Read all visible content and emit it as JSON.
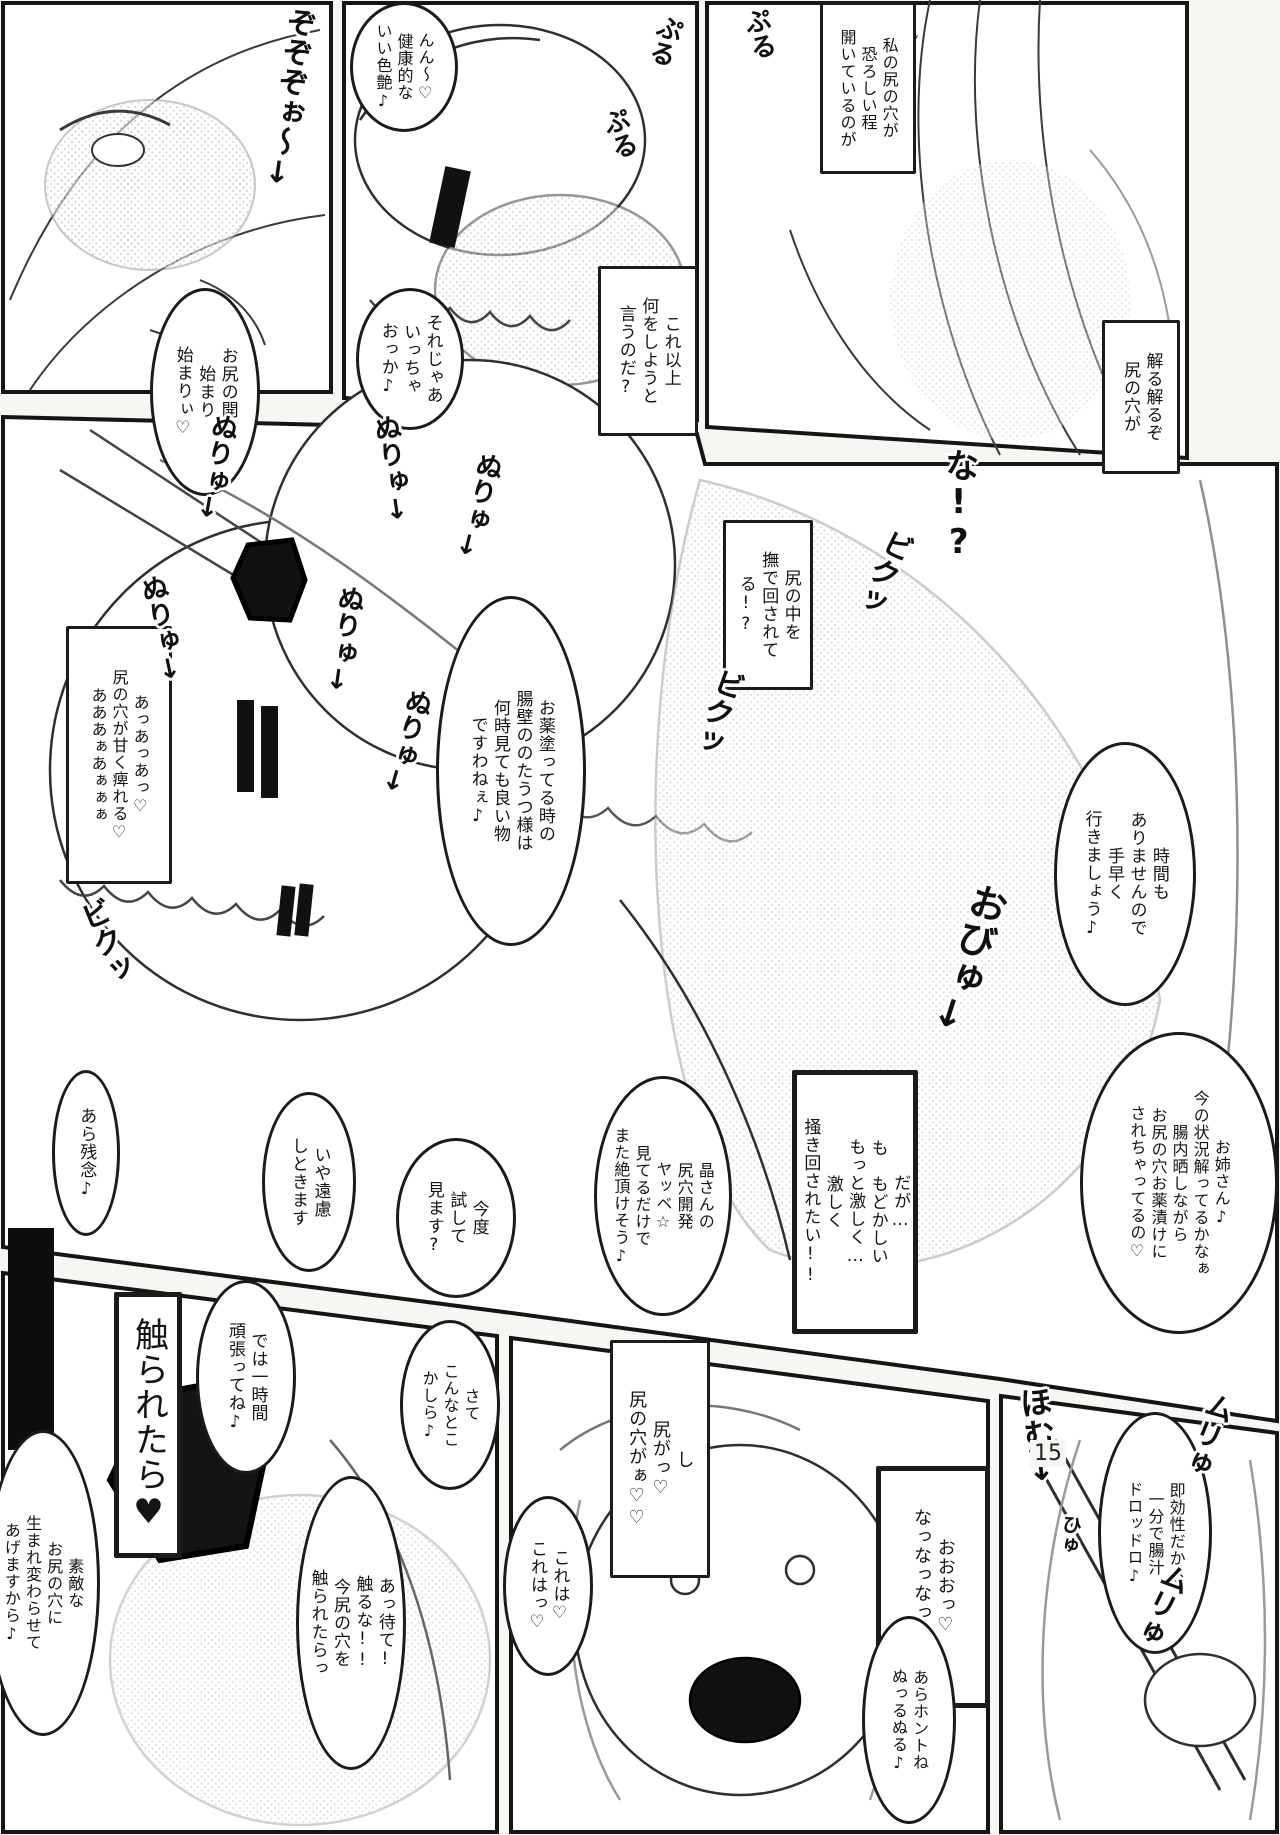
{
  "page_number": "15",
  "colors": {
    "ink": "#1b1b1b",
    "paper": "#ffffff",
    "tone": "#c9c9c9"
  },
  "bubbles": [
    {
      "name": "narration-box-my-hole",
      "kind": "box",
      "text": "私の尻の穴が\n恐ろしい程\n開いているのが",
      "x": 820,
      "y": 2,
      "w": 96,
      "h": 172,
      "fs": 16
    },
    {
      "name": "speech-bubble-healthy-luster",
      "kind": "ellipse",
      "text": "んん〜♡\n健康的な\nいい色艶♪",
      "x": 350,
      "y": 2,
      "w": 108,
      "h": 130,
      "fs": 16
    },
    {
      "name": "narration-box-what-more",
      "kind": "box",
      "text": "これ以上\n何をしようと\n言うのだ?",
      "x": 598,
      "y": 266,
      "w": 100,
      "h": 170,
      "fs": 17
    },
    {
      "name": "speech-bubble-lets-go",
      "kind": "ellipse",
      "text": "それじゃあ\nいっちゃ\nおっか♪",
      "x": 356,
      "y": 288,
      "w": 108,
      "h": 142,
      "fs": 17
    },
    {
      "name": "speech-bubble-development-begins",
      "kind": "ellipse",
      "text": "お尻の開発\n始まり\n始まりぃ♡",
      "x": 150,
      "y": 288,
      "w": 110,
      "h": 208,
      "fs": 17
    },
    {
      "name": "narration-box-i-understand",
      "kind": "box",
      "text": "解る解るぞ\n尻の穴が",
      "x": 1102,
      "y": 320,
      "w": 78,
      "h": 154,
      "fs": 17
    },
    {
      "name": "narration-box-being-rubbed",
      "kind": "box",
      "text": "尻の中を\n撫で回されてる!?",
      "x": 723,
      "y": 520,
      "w": 90,
      "h": 170,
      "fs": 17
    },
    {
      "name": "narration-box-numb-moan",
      "kind": "box",
      "text": "あっあっあっ♡\n尻の穴が甘く痺れる♡\nあああぁあぁぁぁ",
      "x": 66,
      "y": 626,
      "w": 106,
      "h": 258,
      "fs": 16
    },
    {
      "name": "speech-bubble-medicine-view",
      "kind": "ellipse",
      "text": "お薬塗ってる時の\n腸壁ののたうつ様は\n何時見ても良い物\nですわねぇ♪",
      "x": 436,
      "y": 596,
      "w": 150,
      "h": 350,
      "fs": 17
    },
    {
      "name": "speech-bubble-no-time",
      "kind": "ellipse",
      "text": "時間も\nありませんので\n手早く\n行きましょう♪",
      "x": 1054,
      "y": 742,
      "w": 142,
      "h": 264,
      "fs": 17
    },
    {
      "name": "speech-bubble-onee-san",
      "kind": "ellipse",
      "text": "お姉さん♪\n今の状況解ってるかなぁ\n腸内晒しながら\nお尻の穴お薬漬けに\nされちゃってるの♡",
      "x": 1080,
      "y": 1032,
      "w": 198,
      "h": 302,
      "fs": 16
    },
    {
      "name": "narration-box-stir-harder",
      "kind": "boxbold",
      "text": "だが…\nも　もどかしい\nもっと激しく…\n激しく\n掻き回されたい!!",
      "x": 792,
      "y": 1070,
      "w": 126,
      "h": 264,
      "fs": 17
    },
    {
      "name": "speech-bubble-akira-development",
      "kind": "ellipse",
      "text": "晶さんの\n尻穴開発\nヤッベ☆\n見てるだけで\nまた絶頂けそう♪",
      "x": 594,
      "y": 1076,
      "w": 138,
      "h": 240,
      "fs": 16
    },
    {
      "name": "speech-bubble-too-bad",
      "kind": "ellipse",
      "text": "あら残念♪",
      "x": 52,
      "y": 1070,
      "w": 68,
      "h": 166,
      "fs": 17
    },
    {
      "name": "speech-bubble-no-thanks",
      "kind": "ellipse",
      "text": "いや遠慮\nしときます",
      "x": 262,
      "y": 1092,
      "w": 94,
      "h": 180,
      "fs": 17
    },
    {
      "name": "speech-bubble-try-next-time",
      "kind": "ellipse",
      "text": "今度\n試して\n見ます?",
      "x": 396,
      "y": 1138,
      "w": 120,
      "h": 160,
      "fs": 17
    },
    {
      "name": "narration-box-if-touched",
      "kind": "boxbold",
      "text": "触られたら♥",
      "x": 114,
      "y": 1292,
      "w": 68,
      "h": 266,
      "fs": 34
    },
    {
      "name": "speech-bubble-one-hour",
      "kind": "ellipse",
      "text": "では一時間\n頑張ってね♪",
      "x": 196,
      "y": 1280,
      "w": 100,
      "h": 194,
      "fs": 17
    },
    {
      "name": "speech-bubble-about-here",
      "kind": "ellipse",
      "text": "さて\nこんなとこ\nかしら♪",
      "x": 400,
      "y": 1320,
      "w": 100,
      "h": 170,
      "fs": 16
    },
    {
      "name": "speech-bubble-wonderful-hole",
      "kind": "ellipse",
      "text": "素敵な\nお尻の穴に\n生まれ変わらせて\nあげますから♪",
      "x": -14,
      "y": 1430,
      "w": 114,
      "h": 306,
      "fs": 16
    },
    {
      "name": "narration-box-my-butt",
      "kind": "box",
      "text": "し\n尻がっ♡\n尻の穴がぁ♡♡",
      "x": 610,
      "y": 1340,
      "w": 100,
      "h": 238,
      "fs": 18
    },
    {
      "name": "speech-bubble-wait-dont-touch",
      "kind": "ellipse",
      "text": "あっ待て!\n触るな!!\n今尻の穴を\n触られたらっ",
      "x": 296,
      "y": 1476,
      "w": 110,
      "h": 294,
      "fs": 17
    },
    {
      "name": "speech-bubble-this-is",
      "kind": "ellipse",
      "text": "これは♡\nこれはっ♡",
      "x": 503,
      "y": 1496,
      "w": 90,
      "h": 180,
      "fs": 17
    },
    {
      "name": "narration-box-ooo",
      "kind": "boxbold",
      "text": "おおおっ♡\nなっなっなっ!?",
      "x": 876,
      "y": 1466,
      "w": 114,
      "h": 242,
      "fs": 18
    },
    {
      "name": "speech-bubble-fast-acting",
      "kind": "ellipse",
      "text": "即効性だから\n一分で腸汁\nドロッドロ♪",
      "x": 1098,
      "y": 1412,
      "w": 114,
      "h": 242,
      "fs": 16
    },
    {
      "name": "speech-bubble-really-slippery",
      "kind": "ellipse",
      "text": "あらホントね\nぬっるぬる♪",
      "x": 862,
      "y": 1616,
      "w": 94,
      "h": 208,
      "fs": 16
    }
  ],
  "sfx": [
    {
      "name": "sfx-zozozo",
      "text": "ぞぞぞぉ〜↓",
      "x": 272,
      "y": 6,
      "fs": 30,
      "rot": 8
    },
    {
      "name": "sfx-puru-1",
      "text": "ぷる",
      "x": 744,
      "y": 8,
      "fs": 26,
      "rot": -12
    },
    {
      "name": "sfx-puru-2",
      "text": "ぷる",
      "x": 650,
      "y": 14,
      "fs": 26,
      "rot": 16
    },
    {
      "name": "sfx-puru-3",
      "text": "ぷる",
      "x": 604,
      "y": 108,
      "fs": 26,
      "rot": -18
    },
    {
      "name": "sfx-na",
      "text": "な!?",
      "x": 940,
      "y": 448,
      "fs": 34,
      "rot": 0
    },
    {
      "name": "sfx-biku-1",
      "text": "ビクッ",
      "x": 866,
      "y": 526,
      "fs": 30,
      "rot": 26
    },
    {
      "name": "sfx-biku-2",
      "text": "ビクッ",
      "x": 700,
      "y": 666,
      "fs": 30,
      "rot": 20
    },
    {
      "name": "sfx-biku-3",
      "text": "ビクッ",
      "x": 88,
      "y": 898,
      "fs": 30,
      "rot": -22
    },
    {
      "name": "sfx-nuryu-1",
      "text": "ぬりゅ↓",
      "x": 200,
      "y": 412,
      "fs": 27,
      "rot": 10
    },
    {
      "name": "sfx-nuryu-2",
      "text": "ぬりゅ↓",
      "x": 376,
      "y": 414,
      "fs": 27,
      "rot": -8
    },
    {
      "name": "sfx-nuryu-3",
      "text": "ぬりゅ↓",
      "x": 462,
      "y": 450,
      "fs": 27,
      "rot": 14
    },
    {
      "name": "sfx-nuryu-4",
      "text": "ぬりゅ↓",
      "x": 146,
      "y": 574,
      "fs": 27,
      "rot": -12
    },
    {
      "name": "sfx-nuryu-5",
      "text": "ぬりゅ↓",
      "x": 328,
      "y": 584,
      "fs": 27,
      "rot": 8
    },
    {
      "name": "sfx-nuryu-6",
      "text": "ぬりゅ↓",
      "x": 390,
      "y": 686,
      "fs": 27,
      "rot": 16
    },
    {
      "name": "sfx-obyu",
      "text": "おびゅ↓",
      "x": 946,
      "y": 880,
      "fs": 38,
      "rot": 18
    },
    {
      "name": "sfx-homu",
      "text": "ほむ↓",
      "x": 1020,
      "y": 1386,
      "fs": 32,
      "rot": -6
    },
    {
      "name": "sfx-muryu-1",
      "text": "ムリゅ",
      "x": 1192,
      "y": 1390,
      "fs": 29,
      "rot": 22
    },
    {
      "name": "sfx-muryu-2",
      "text": "ムリゅ",
      "x": 1146,
      "y": 1560,
      "fs": 29,
      "rot": 26
    },
    {
      "name": "sfx-hyu",
      "text": "ひゅ",
      "x": 1058,
      "y": 1514,
      "fs": 20,
      "rot": 10
    }
  ]
}
